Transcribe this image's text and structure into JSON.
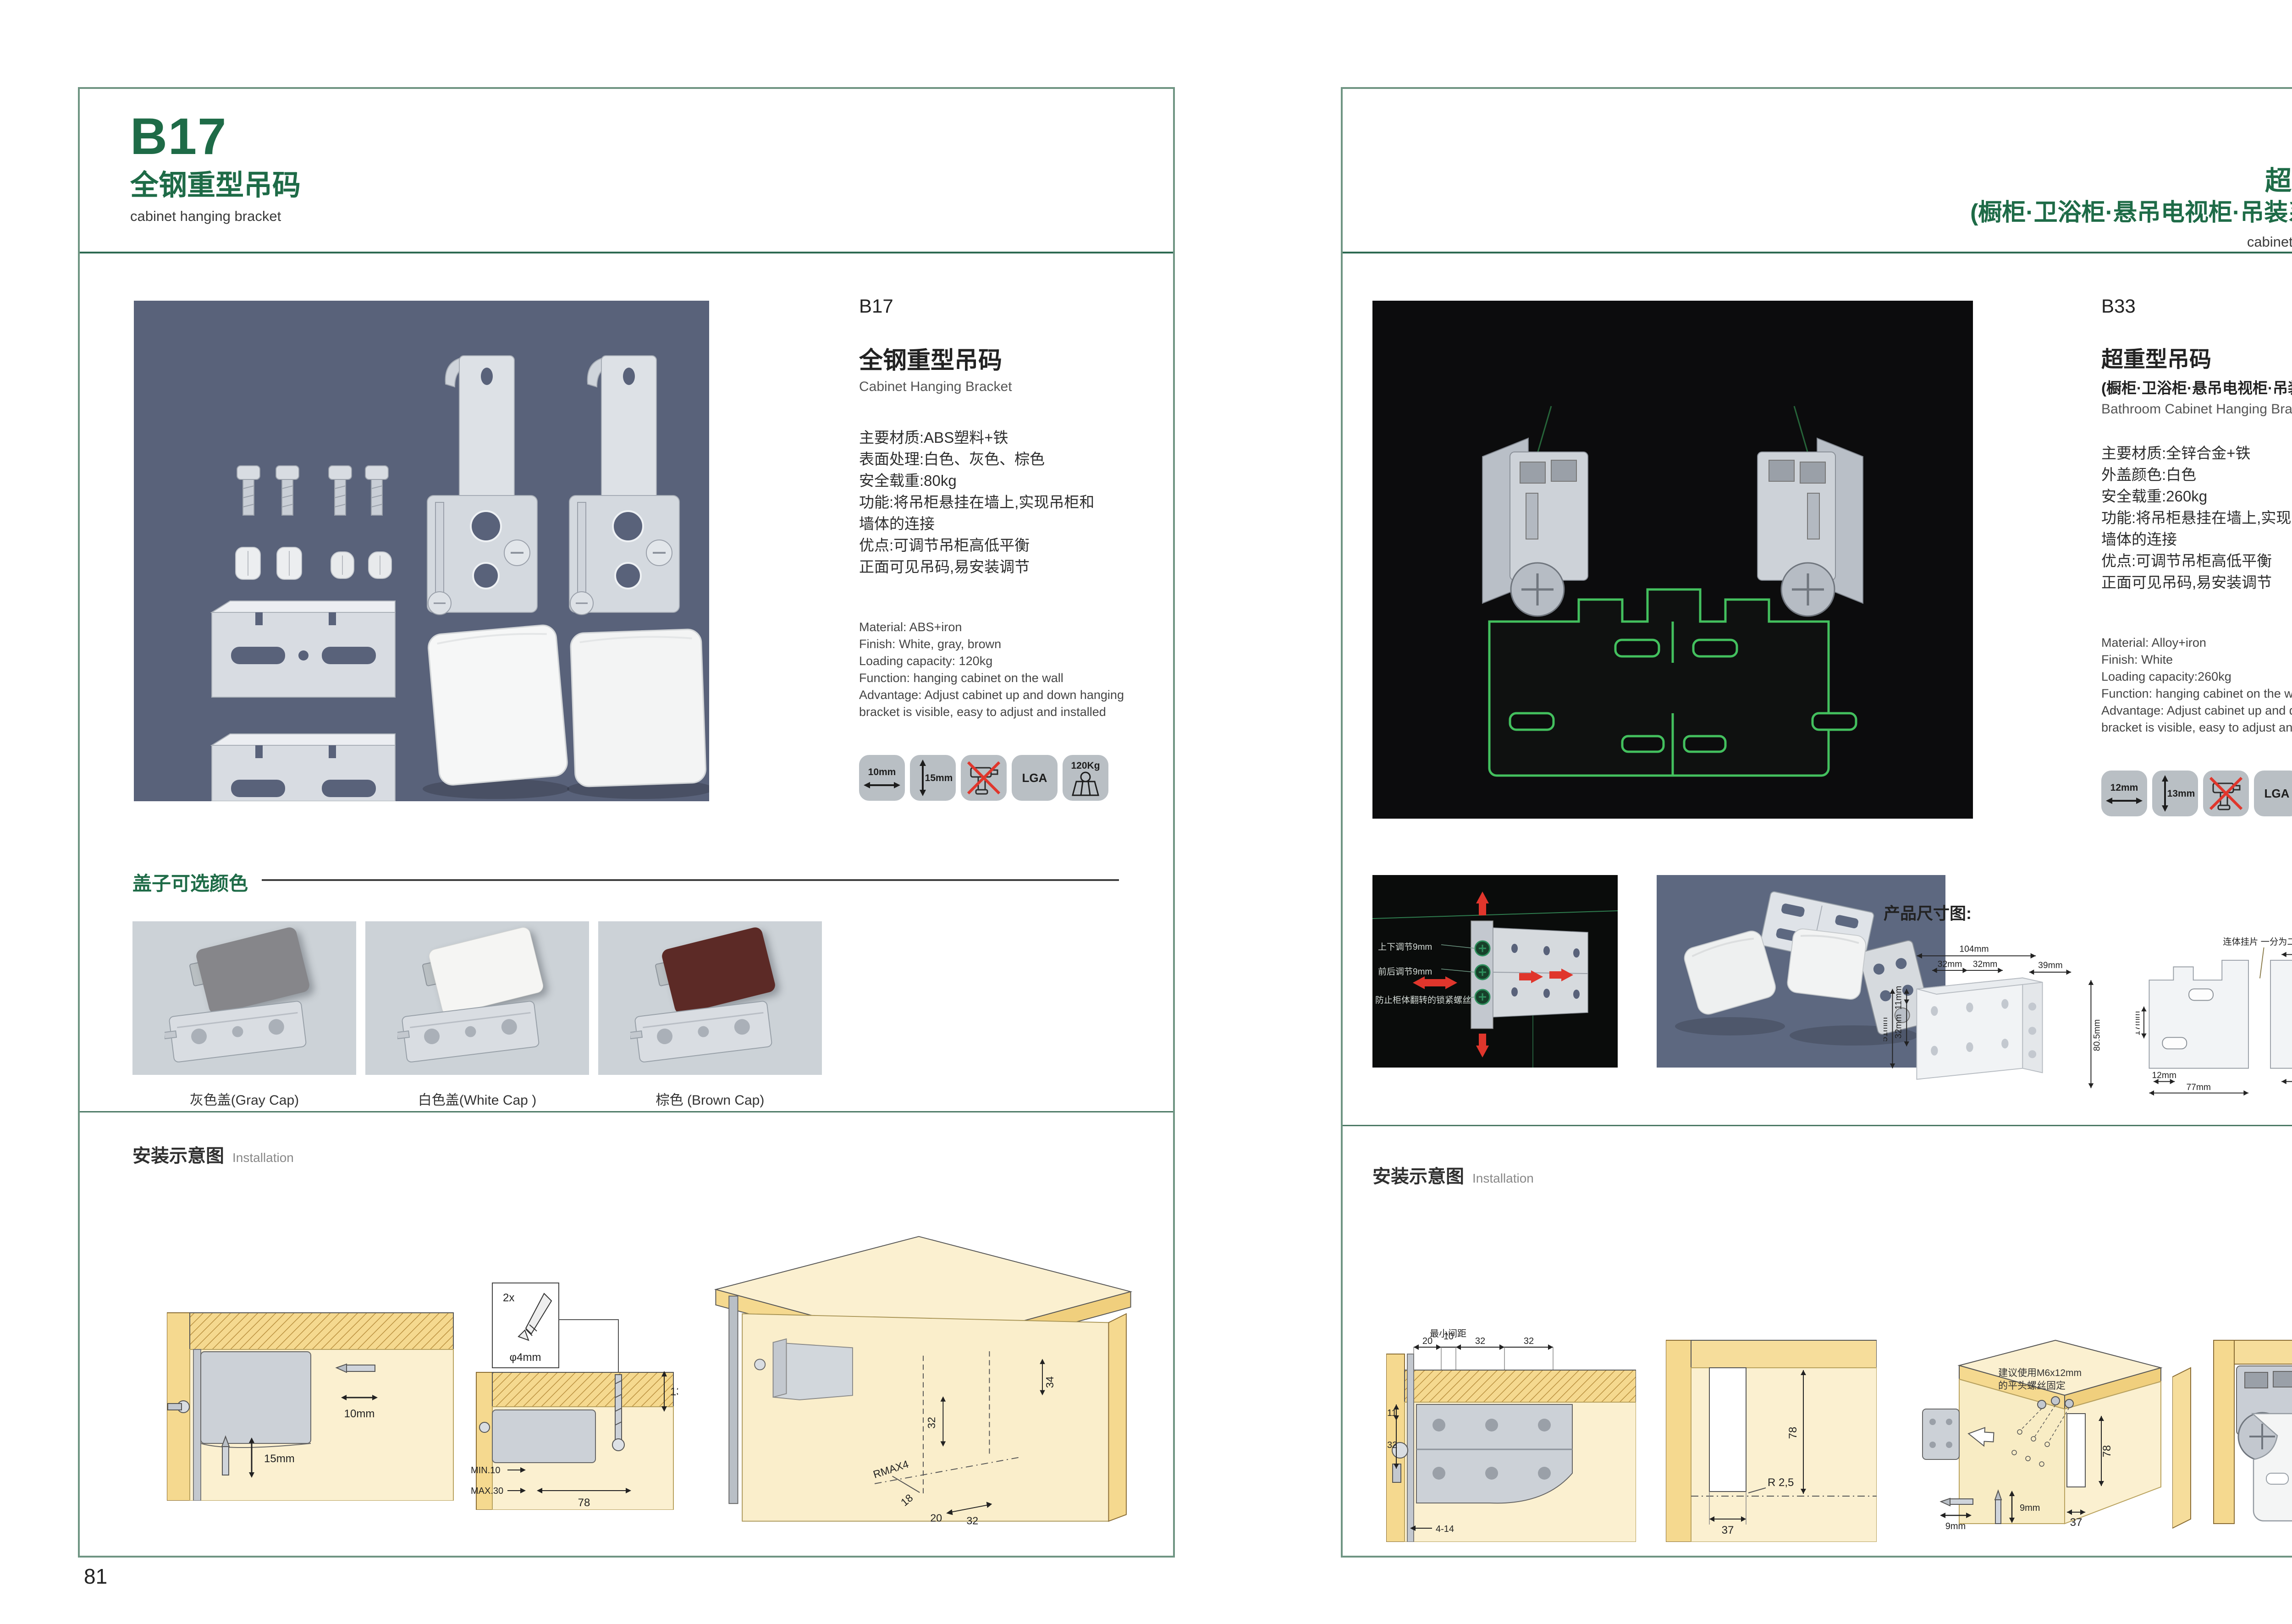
{
  "colors": {
    "brand_green": "#1e6b47",
    "frame_green": "#6f9583",
    "separator_green": "#2e6a52",
    "photo_slate_bg": "#59627a",
    "photo_black_bg": "#0c0c0d",
    "caps_photo_bg": "#ccd2d7",
    "green_outline": "#43c05e",
    "wood_yellow": "#f5d98f",
    "wood_face": "#fbf0d0",
    "red_arrow": "#e0362c"
  },
  "left_page": {
    "header": {
      "code": "B17",
      "title_cn": "全钢重型吊码",
      "subtitle_en": "cabinet hanging bracket"
    },
    "detail": {
      "code": "B17",
      "name_cn": "全钢重型吊码",
      "name_en": "Cabinet Hanging Bracket",
      "specs_cn": [
        "主要材质:ABS塑料+铁",
        "表面处理:白色、灰色、棕色",
        "安全载重:80kg",
        "功能:将吊柜悬挂在墙上,实现吊柜和",
        "墙体的连接",
        "优点:可调节吊柜高低平衡",
        "正面可见吊码,易安装调节"
      ],
      "specs_en": [
        "Material: ABS+iron",
        "Finish: White, gray, brown",
        "Loading capacity: 120kg",
        "Function: hanging cabinet on the wall",
        "Advantage: Adjust cabinet up and down hanging",
        "bracket is visible, easy to adjust and installed"
      ],
      "badges": {
        "width": "10mm",
        "height": "15mm",
        "cert": "LGA",
        "load": "120Kg"
      }
    },
    "caps": {
      "heading": "盖子可选颜色",
      "items": [
        {
          "caption": "灰色盖(Gray Cap)",
          "color": "#86868a"
        },
        {
          "caption": "白色盖(White Cap )",
          "color": "#f5f5f3"
        },
        {
          "caption": "棕色 (Brown Cap)",
          "color": "#5c2a26"
        }
      ]
    },
    "install": {
      "heading_cn": "安装示意图",
      "heading_en": "Installation",
      "d1": {
        "width": "10mm",
        "height": "15mm"
      },
      "d2": {
        "count": "2x",
        "dia": "φ4mm",
        "depth": "13",
        "min": "MIN.10",
        "max": "MAX.30",
        "span": "78"
      },
      "d3": {
        "back_offset": "34",
        "pitch": "32",
        "radius": "RMAX4",
        "d18": "18",
        "d20": "20",
        "d32": "32"
      }
    },
    "page_number": "81"
  },
  "right_page": {
    "header": {
      "code": "B33",
      "title_cn": "超重型吊码",
      "subtitle_cn": "(橱柜·卫浴柜·悬吊电视柜·吊装系统 专用)",
      "subtitle_en": "cabinet hanging bracket"
    },
    "detail": {
      "code": "B33",
      "name_cn": "超重型吊码",
      "sub_cn": "(橱柜·卫浴柜·悬吊电视柜·吊装系统 专用)",
      "name_en": "Bathroom Cabinet Hanging Bracket",
      "specs_cn": [
        "主要材质:全锌合金+铁",
        "外盖颜色:白色",
        "安全载重:260kg",
        "功能:将吊柜悬挂在墙上,实现吊柜和",
        "墙体的连接",
        "优点:可调节吊柜高低平衡",
        "正面可见吊码,易安装调节"
      ],
      "specs_en": [
        "Material: Alloy+iron",
        "Finish: White",
        "Loading capacity:260kg",
        "Function: hanging cabinet on the wall",
        "Advantage: Adjust cabinet up and down hanging",
        "bracket is visible, easy to adjust and installed"
      ],
      "badges": {
        "width": "12mm",
        "height": "13mm",
        "cert": "LGA",
        "load": "260Kg"
      }
    },
    "features": {
      "labels": [
        "上下调节9mm",
        "前后调节9mm",
        "防止柜体翻转的锁紧螺丝"
      ]
    },
    "dims": {
      "heading": "产品尺寸图:",
      "bracket": {
        "w": "104mm",
        "p1": "32mm",
        "p2": "32mm",
        "side": "39mm",
        "l1": "11mm",
        "l2": "32mm",
        "l3": "51mm",
        "h": "80.5mm"
      },
      "plate": {
        "label": "连体挂片 一分为二",
        "top": "55mm",
        "r1": "39mm",
        "r2": "55mm",
        "r3": "8mm",
        "l1": "17mm",
        "b1": "12mm",
        "b2": "63mm",
        "b3": "77mm"
      }
    },
    "install": {
      "heading_cn": "安装示意图",
      "heading_en": "Installation",
      "d1": {
        "note": "最小间距",
        "t1": "20",
        "t2": "10",
        "t3": "32",
        "t4": "32",
        "l1": "11",
        "l2": "32",
        "b": "4-14"
      },
      "d2": {
        "v": "78",
        "r": "R 2,5",
        "b": "37"
      },
      "d3": {
        "note1": "建议使用M6x12mm",
        "note2": "的平头螺丝固定",
        "v": "78",
        "b": "37",
        "bit_h": "9mm",
        "bit_v": "9mm"
      }
    },
    "page_number": "82"
  }
}
